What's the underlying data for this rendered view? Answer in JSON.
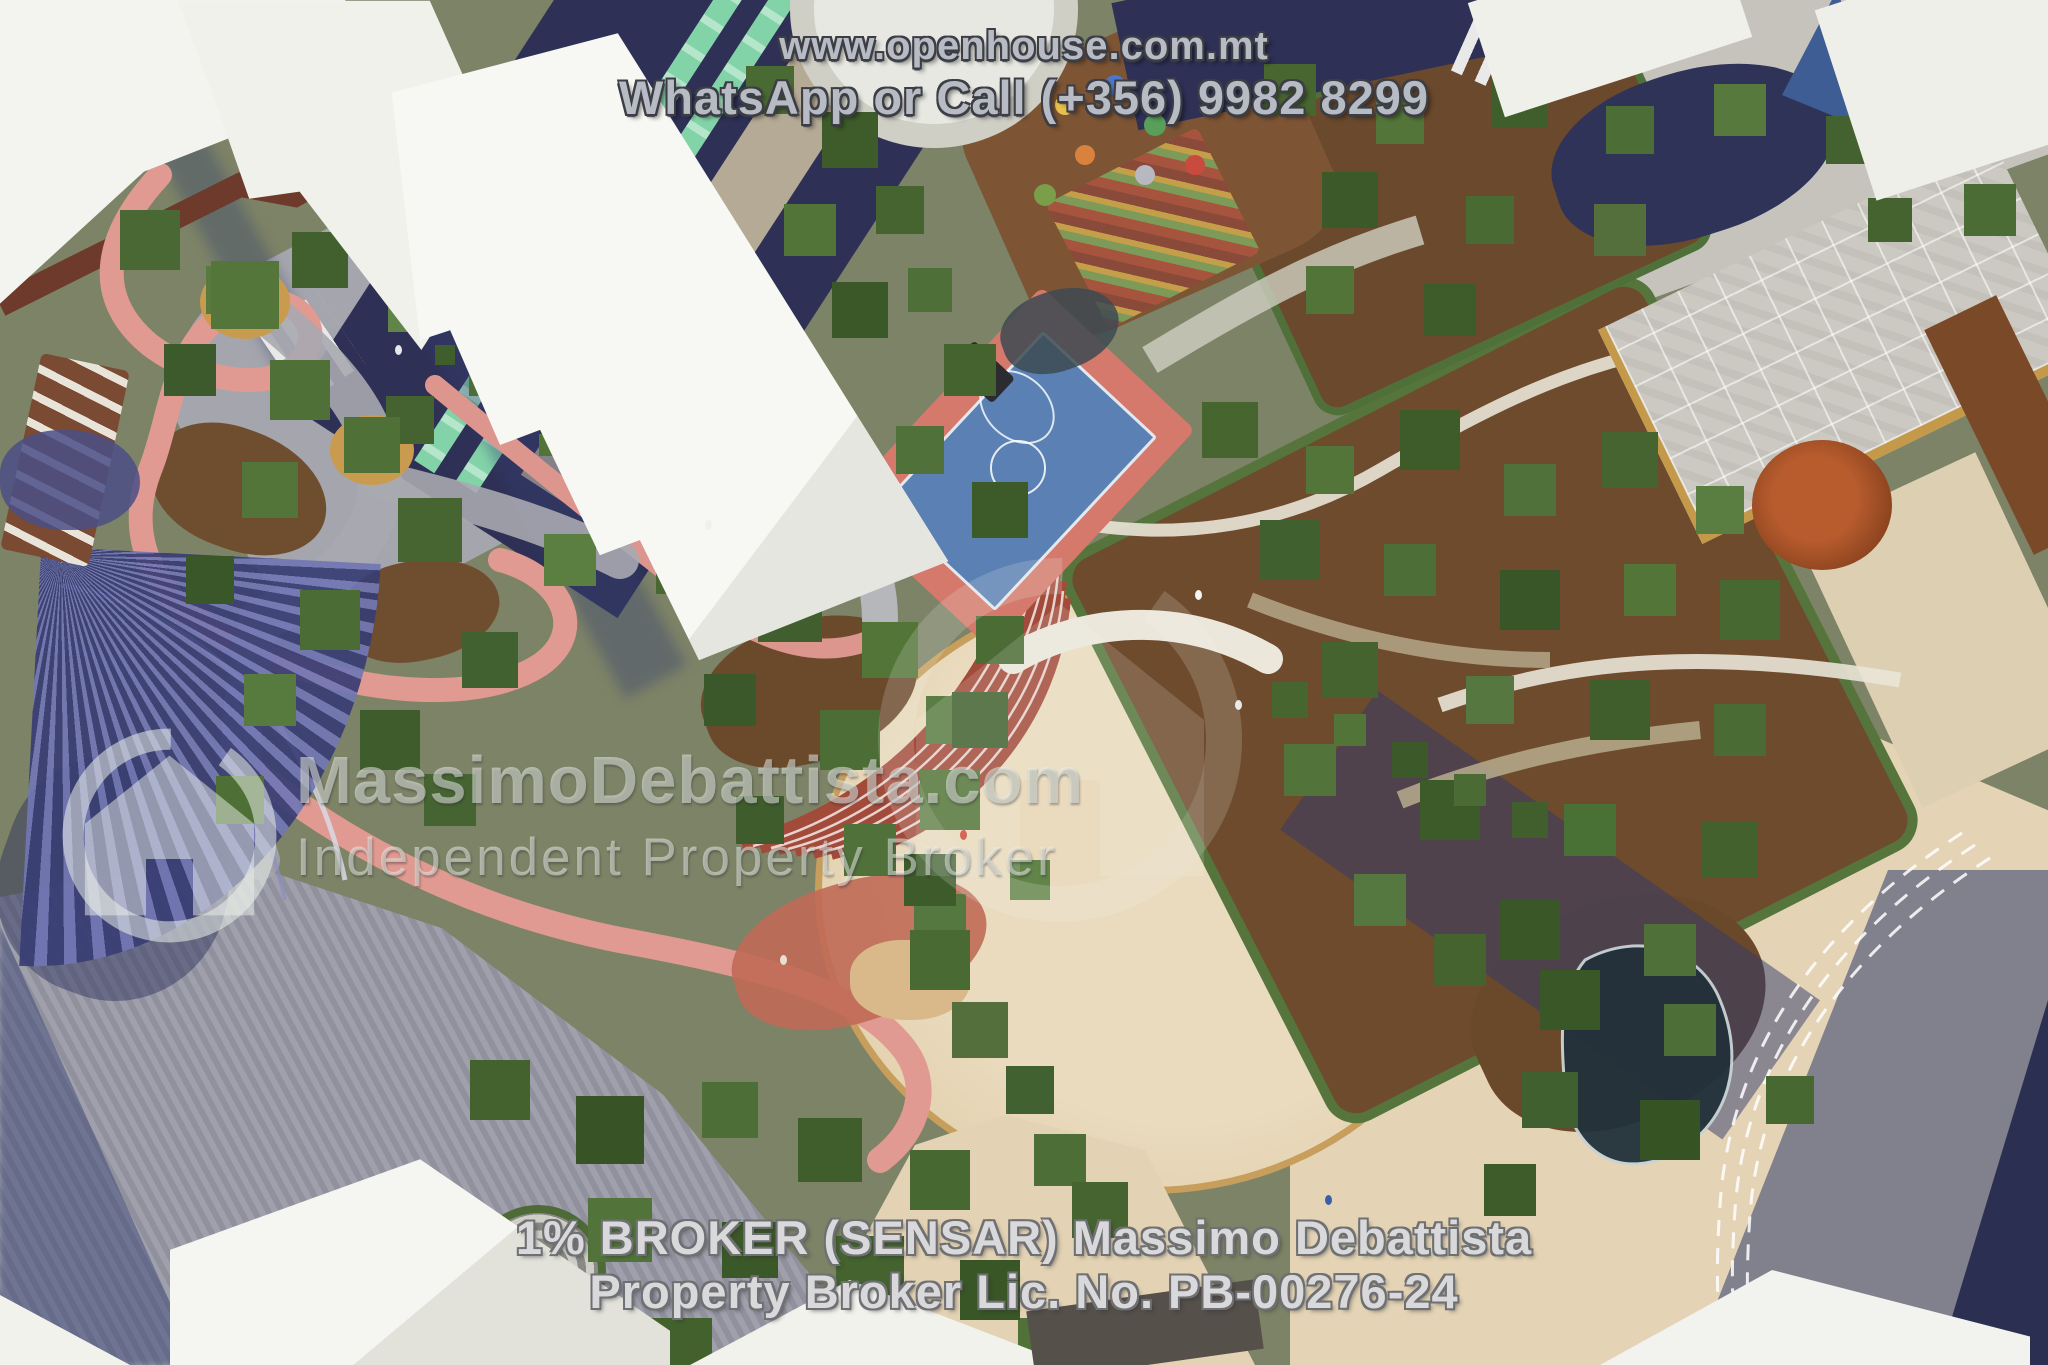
{
  "meta": {
    "description": "Aerial 3D architectural rendering of a landscaped public park and residential development with basketball court, winding pink paths, circular plaza, amphitheatre steps, pergola and white apartment blocks",
    "image_type": "real-estate marketing render"
  },
  "overlay": {
    "top": {
      "website": "www.openhouse.com.mt",
      "contact": "WhatsApp or Call (+356) 9982 8299"
    },
    "watermark": {
      "brand": "MassimoDebattista.com",
      "tagline": "Independent Property Broker"
    },
    "bottom": {
      "line1": "1% BROKER (SENSAR) Massimo Debattista",
      "line2": "Property Broker Lic. No. PB-00276-24"
    }
  },
  "colors": {
    "overlay_text": "#b7bbc3",
    "overlay_outline": "#3c3d45",
    "bottom_text": "#d9d9db",
    "watermark_text": "rgba(238,243,238,0.52)",
    "building_white": "#f5f5f1",
    "road_navy": "#2e3056",
    "bike_lane_green": "#83d3a8",
    "court_blue": "#5a80b4",
    "court_surround_red": "#d4796b",
    "path_pink": "#e09a91",
    "plaza_beige": "#e8d8ba",
    "paving_gray": "#9899a5",
    "tree_green": "#4c6b35",
    "earth_brown": "#6e4b2d",
    "shadow_blue": "#3d4c7e",
    "steps_red": "#a34b3b",
    "terracotta": "#b05a2c"
  }
}
